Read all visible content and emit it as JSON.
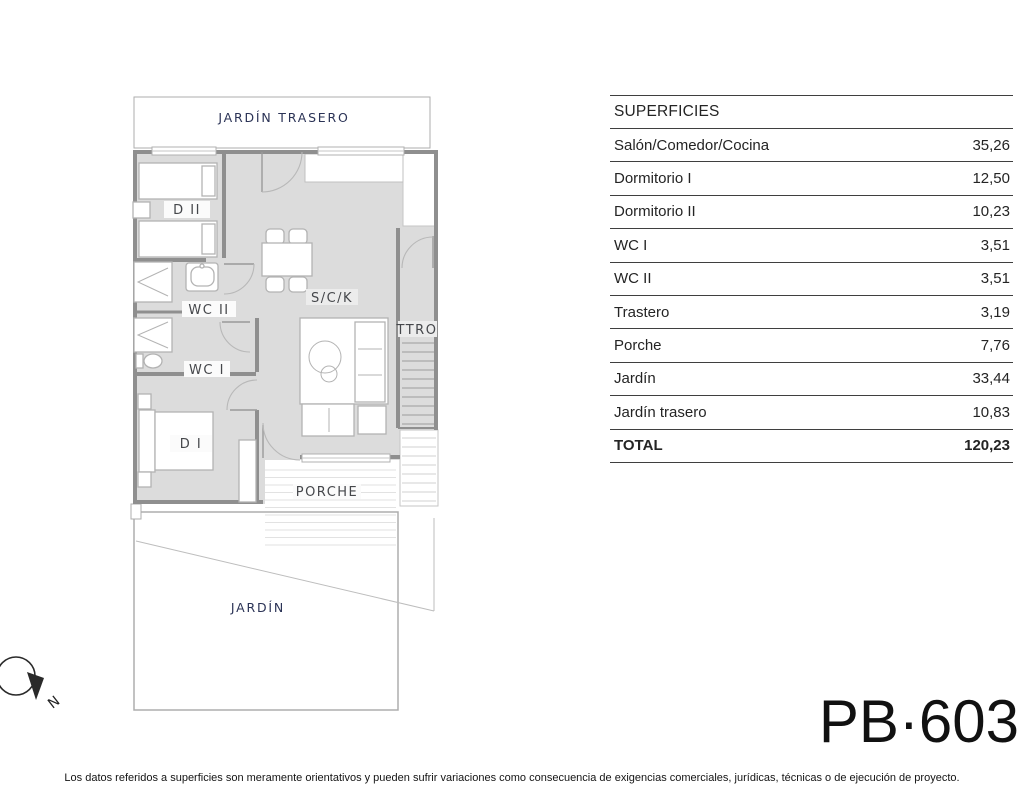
{
  "plan": {
    "labels": {
      "jardin_trasero": "JARDÍN TRASERO",
      "dormitorio_2": "D II",
      "wc_2": "WC II",
      "wc_1": "WC I",
      "dormitorio_1": "D I",
      "salon_comedor_cocina": "S/C/K",
      "trastero": "TTRO",
      "porche": "PORCHE",
      "jardin": "JARDÍN"
    }
  },
  "compass": {
    "north_label": "N"
  },
  "table": {
    "title": "SUPERFICIES",
    "rows": [
      {
        "label": "Salón/Comedor/Cocina",
        "value": "35,26"
      },
      {
        "label": "Dormitorio I",
        "value": "12,50"
      },
      {
        "label": "Dormitorio II",
        "value": "10,23"
      },
      {
        "label": "WC I",
        "value": "3,51"
      },
      {
        "label": "WC II",
        "value": "3,51"
      },
      {
        "label": "Trastero",
        "value": "3,19"
      },
      {
        "label": "Porche",
        "value": "7,76"
      },
      {
        "label": "Jardín",
        "value": "33,44"
      },
      {
        "label": "Jardín trasero",
        "value": "10,83"
      }
    ],
    "total": {
      "label": "TOTAL",
      "value": "120,23"
    }
  },
  "footer": {
    "plan_code": "PB·603",
    "disclaimer": "Los datos referidos a superficies son meramente orientativos y pueden sufrir variaciones como consecuencia de exigencias comerciales, jurídicas, técnicas o de ejecución de proyecto."
  },
  "colors": {
    "room_fill": "#dcdcdc",
    "wall": "#8f8f8f",
    "accent_navy": "#2b3356",
    "table_line": "#3f3f3f"
  }
}
